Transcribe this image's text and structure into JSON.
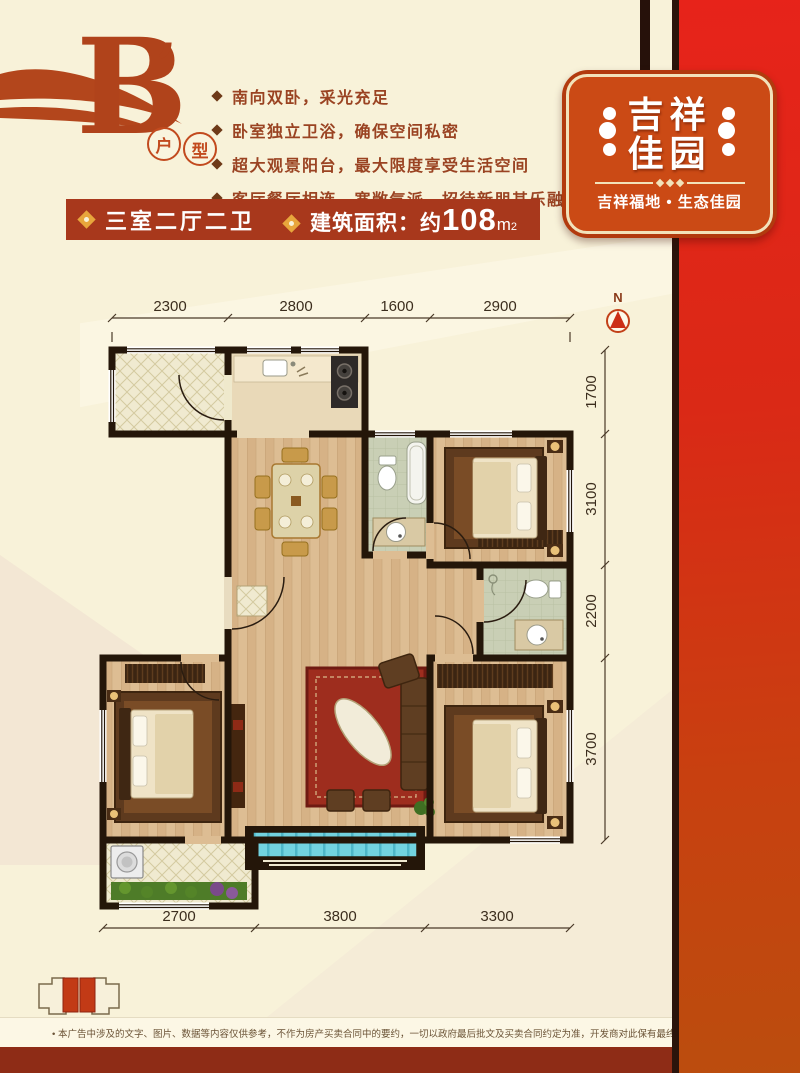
{
  "header": {
    "unit_letter": "B",
    "unit_apostrophe": "’",
    "unit_tag": [
      "户",
      "型"
    ],
    "features": [
      "南向双卧，采光充足",
      "卧室独立卫浴，确保空间私密",
      "超大观景阳台，最大限度享受生活空间",
      "客厅餐厅相连，宽敞气派，招待新朋其乐融融"
    ],
    "banner": {
      "spec": "三室二厅二卫",
      "area_label": "建筑面积：",
      "area_approx": "约",
      "area_value": "108",
      "area_unit": "m",
      "area_sup": "2"
    }
  },
  "badge": {
    "line1": "吉祥",
    "line2": "佳园",
    "tagline": "吉祥福地 • 生态佳园"
  },
  "plan": {
    "north_label": "N",
    "dims_top": [
      "2300",
      "2800",
      "1600",
      "2900"
    ],
    "dims_right": [
      "1700",
      "3100",
      "2200",
      "3700"
    ],
    "dims_bottom": [
      "2700",
      "3800",
      "3300"
    ]
  },
  "footer": {
    "disclaimer": "• 本广告中涉及的文字、图片、数据等内容仅供参考，不作为房产买卖合同中的要约，一切以政府最后批文及买卖合同约定为准，开发商对此保有最终解释权。"
  },
  "colors": {
    "accent_red": "#e6231a",
    "banner_red": "#a8381c",
    "badge_red": "#cb4a15",
    "cream_bg": "#f8f2d9"
  }
}
